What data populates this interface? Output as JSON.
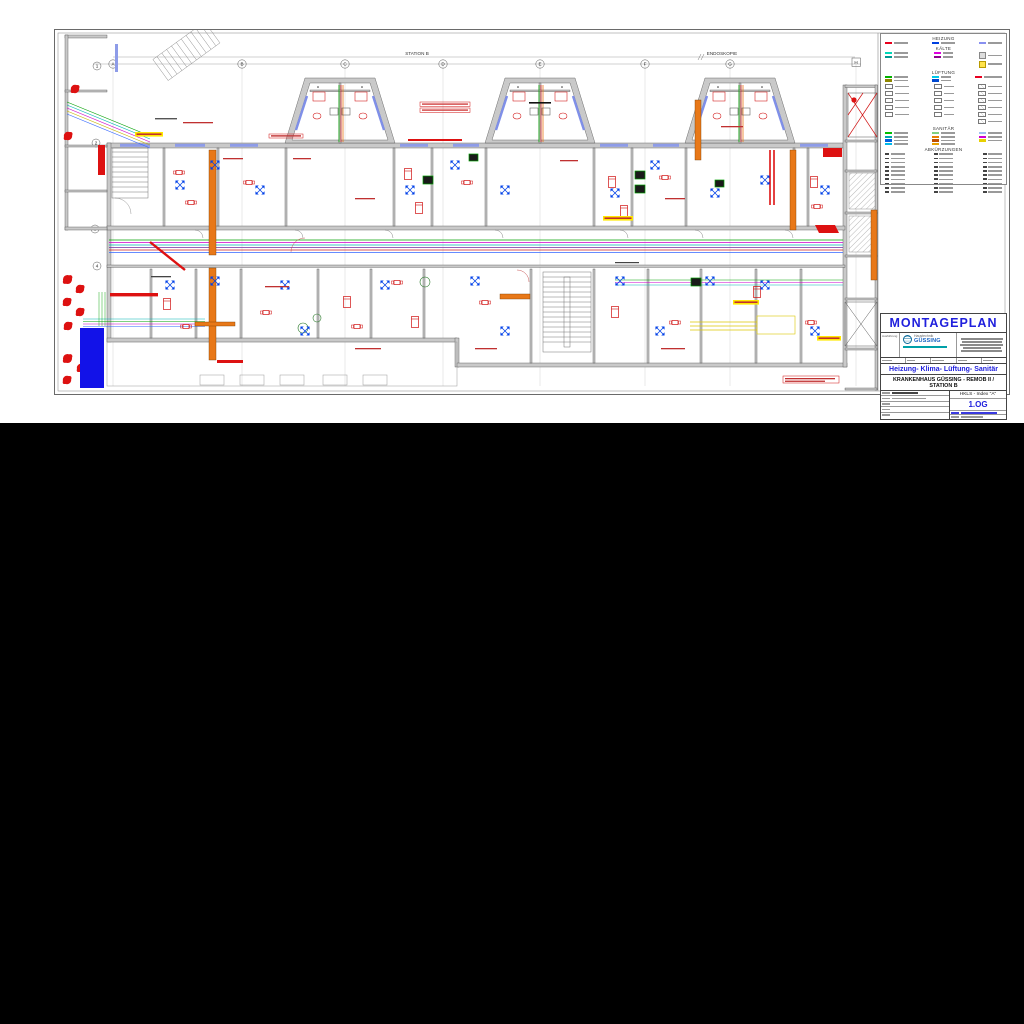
{
  "page": {
    "background": "#000000",
    "paper": "#ffffff"
  },
  "plan": {
    "station_label": "STATION B",
    "endoskopie_label": "ENDOSKOPIE",
    "grid_letters": [
      "A",
      "B",
      "C",
      "D",
      "E",
      "F",
      "G",
      "H"
    ],
    "grid_numbers": [
      "1",
      "2",
      "3",
      "4"
    ]
  },
  "legend": {
    "heading_heizung": "HEIZUNG",
    "heading_kaelte": "KÄLTE",
    "heading_lueftung": "LÜFTUNG",
    "heading_sanitaer": "SANITÄR",
    "heading_abkuerzungen": "ABKÜRZUNGEN",
    "colors": {
      "heizung_vl": "#e8001c",
      "heizung_rl": "#0040e0",
      "heizkoerper": "#8890f0",
      "kaelte_1": "#00d8b8",
      "kaelte_2": "#009890",
      "kaelte_3": "#e000e0",
      "kaelte_4": "#900090",
      "zuluft": "#00b000",
      "fortluft": "#908800",
      "abluft": "#00c8e8",
      "aussenluft": "#0048d0",
      "brandschutz": "#e80020",
      "sanitaer": [
        "#00c000",
        "#00a8a8",
        "#0060e0",
        "#00b8e8",
        "#80d080",
        "#e88000",
        "#c05000",
        "#e8a000",
        "#a0c0f0",
        "#d000d0",
        "#e8d000"
      ]
    }
  },
  "titleblock": {
    "title": "MONTAGEPLAN",
    "ausfuehrung_label": "Ausführung",
    "company_pre": "Haustechnik",
    "company_name": "GÜSSING",
    "subtitle": "Heizung- Klima- Lüftung- Sanitär",
    "project": "KRANKENHAUS GÜSSING - REMOB II / STATION B",
    "index_label": "HKLS - Index \"A\"",
    "floor": "1.OG",
    "accent_blue": "#2020dd"
  }
}
